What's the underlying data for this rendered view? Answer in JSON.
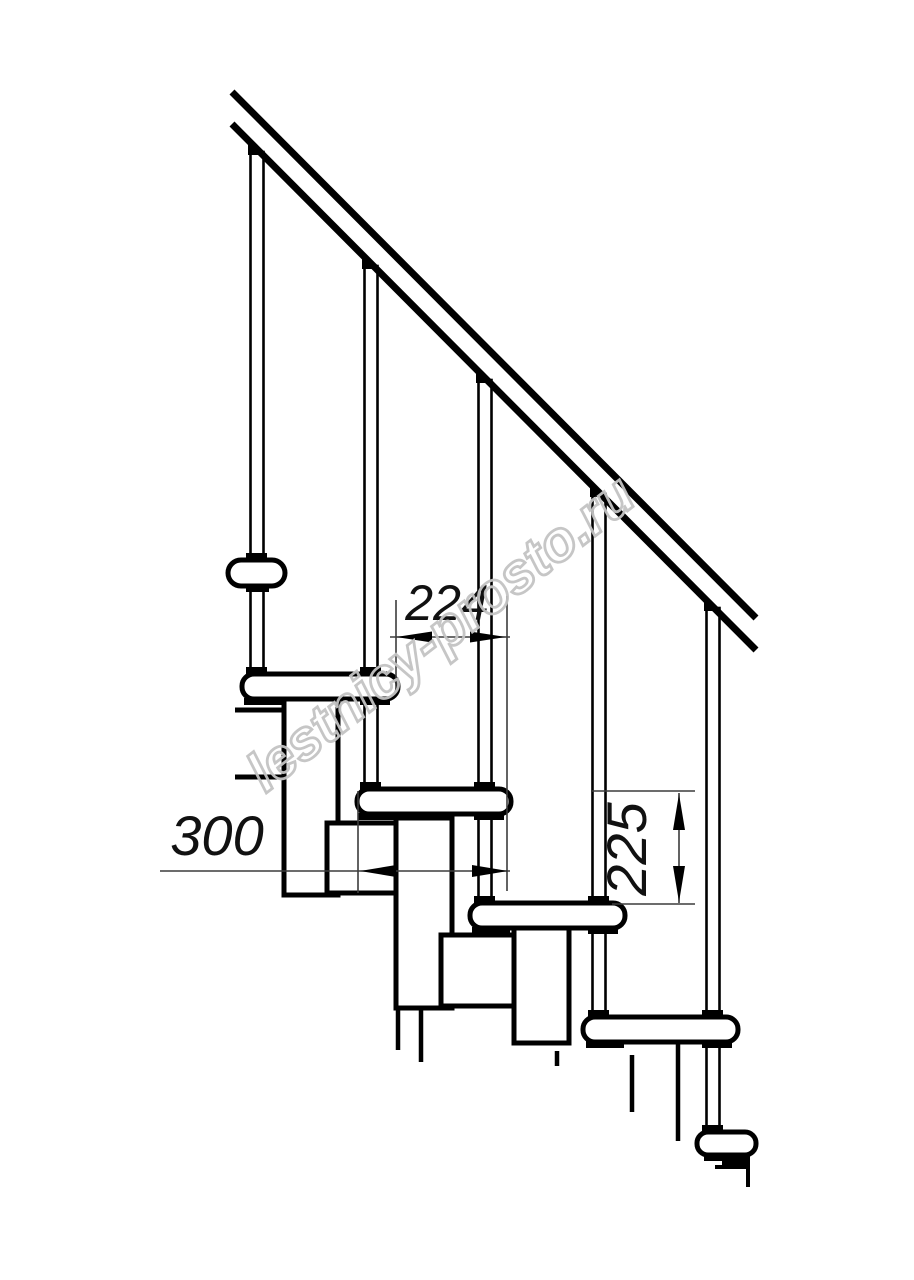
{
  "drawing": {
    "title": "staircase-side-view",
    "watermark": {
      "text": "lestnicy-prosto.ru",
      "color": "#c3c3c3"
    },
    "dimensions": {
      "step_run": {
        "value": "224"
      },
      "module_length": {
        "value": "300"
      },
      "step_rise": {
        "value": "225"
      }
    },
    "colors": {
      "line": "#000000",
      "background": "#ffffff"
    }
  }
}
